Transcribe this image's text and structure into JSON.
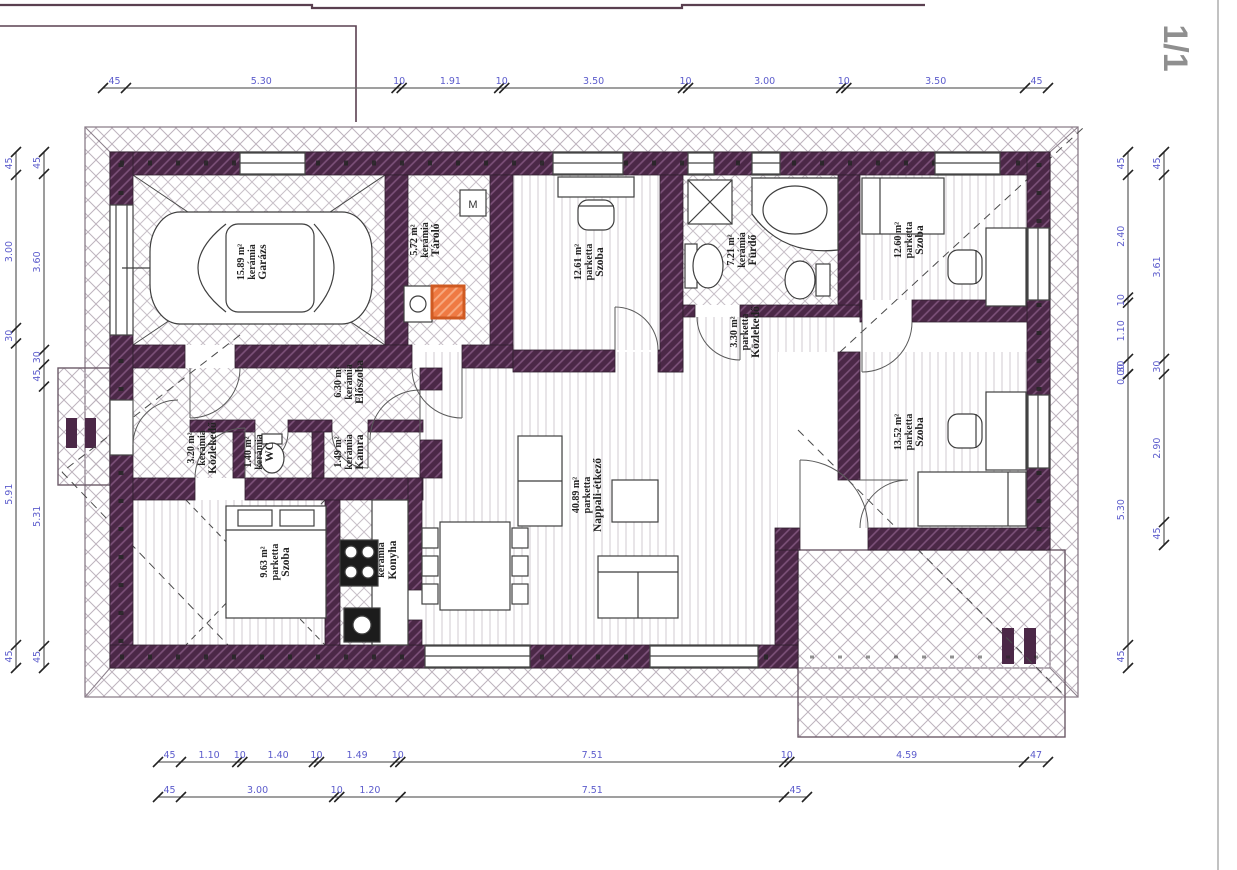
{
  "sheet": {
    "page_indicator": "1/1"
  },
  "plan": {
    "washer_label": "M"
  },
  "colors": {
    "wall": "#4b2847",
    "wall_hatch": "#7d527a",
    "dimension_text": "#5c5ccc",
    "highlight_orange": "#ef7a43",
    "highlight_orange_border": "#cf5a22",
    "line": "#3c3c3c"
  },
  "rooms": [
    {
      "name": "Garázs",
      "material": "kerámia",
      "area": "15.89 m²"
    },
    {
      "name": "Tároló",
      "material": "kerámia",
      "area": "5.72 m²"
    },
    {
      "name": "Szoba",
      "material": "parketta",
      "area": "12.61 m²"
    },
    {
      "name": "Fürdő",
      "material": "kerámia",
      "area": "7.21 m²"
    },
    {
      "name": "Szoba",
      "material": "parketta",
      "area": "12.60 m²"
    },
    {
      "name": "Közlekedő",
      "material": "parketta",
      "area": "3.30 m²"
    },
    {
      "name": "Szoba",
      "material": "parketta",
      "area": "13.52 m²"
    },
    {
      "name": "Nappali-étkező",
      "material": "parketta",
      "area": "40.89 m²"
    },
    {
      "name": "Szoba",
      "material": "parketta",
      "area": "9.63 m²"
    },
    {
      "name": "Konyha",
      "material": "kerámia",
      "area": ""
    },
    {
      "name": "Előszoba",
      "material": "kerámia",
      "area": "6.30 m²"
    },
    {
      "name": "Közlekedő",
      "material": "kerámia",
      "area": "3.20 m²"
    },
    {
      "name": "WC",
      "material": "kerámia",
      "area": "1.40 m²"
    },
    {
      "name": "Kamra",
      "material": "kerámia",
      "area": "1.49 m²"
    }
  ],
  "dimensions": {
    "top": [
      "45",
      "5.30",
      "10",
      "1.91",
      "10",
      "3.50",
      "10",
      "3.00",
      "10",
      "3.50",
      "45"
    ],
    "bottom_row1": [
      "45",
      "1.10",
      "10",
      "1.40",
      "10",
      "1.49",
      "10",
      "7.51",
      "10",
      "4.59",
      "47"
    ],
    "bottom_row2": [
      "45",
      "3.00",
      "10",
      "1.20",
      "7.51",
      "45"
    ],
    "left_outer": [
      "45",
      "3.00",
      "30",
      "5.91",
      "45"
    ],
    "left_inner": [
      "45",
      "3.60",
      "30",
      "45",
      "5.31",
      "45"
    ],
    "right_inner": [
      "45",
      "2.40",
      "10",
      "1.10",
      "30",
      "0.00",
      "5.30",
      "45"
    ],
    "right_outer": [
      "45",
      "3.61",
      "30",
      "2.90",
      "45"
    ]
  }
}
